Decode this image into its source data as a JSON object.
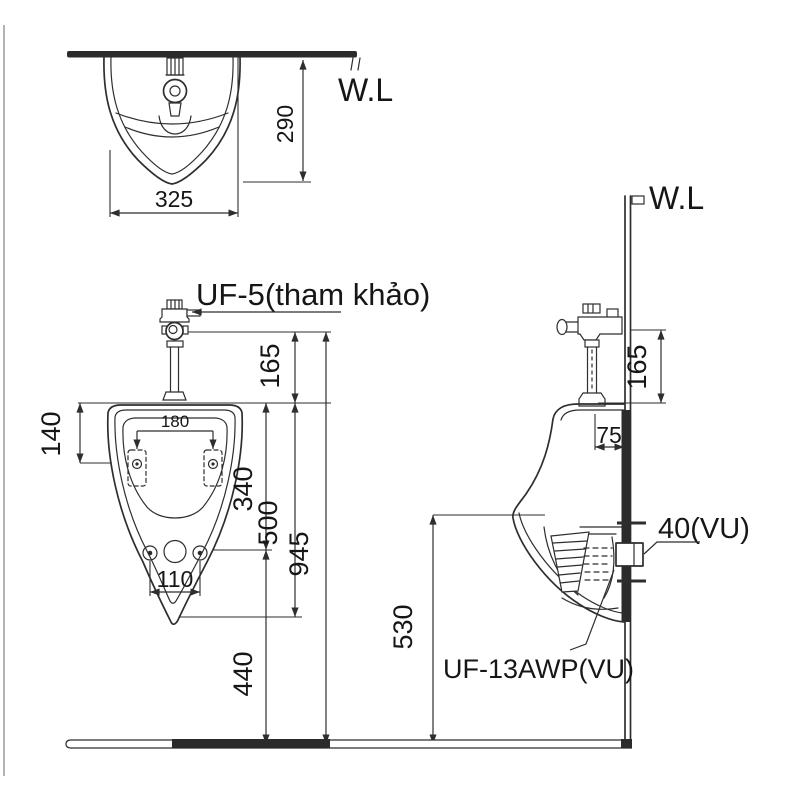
{
  "drawing": {
    "top_view": {
      "water_line_label": "W.L",
      "width_dim": "325",
      "depth_dim": "290"
    },
    "front_view": {
      "valve_label": "UF-5(tham khảo)",
      "valve_to_rim_dim": "165",
      "hanger_drop_dim": "140",
      "hanger_spacing_dim": "180",
      "rim_to_outlet_dim": "340",
      "rim_to_lip_dim": "500",
      "overall_height_dim": "945",
      "bolt_spacing_dim": "110",
      "outlet_to_floor_dim": "440"
    },
    "side_view": {
      "water_line_label": "W.L",
      "valve_to_rim_dim": "165",
      "valve_offset_dim": "75",
      "lip_to_floor_dim": "530",
      "outlet_pipe_label": "40(VU)",
      "trap_model_label": "UF-13AWP(VU)"
    },
    "colors": {
      "line": "#2e2e2e",
      "text": "#161616",
      "background": "#ffffff"
    }
  }
}
